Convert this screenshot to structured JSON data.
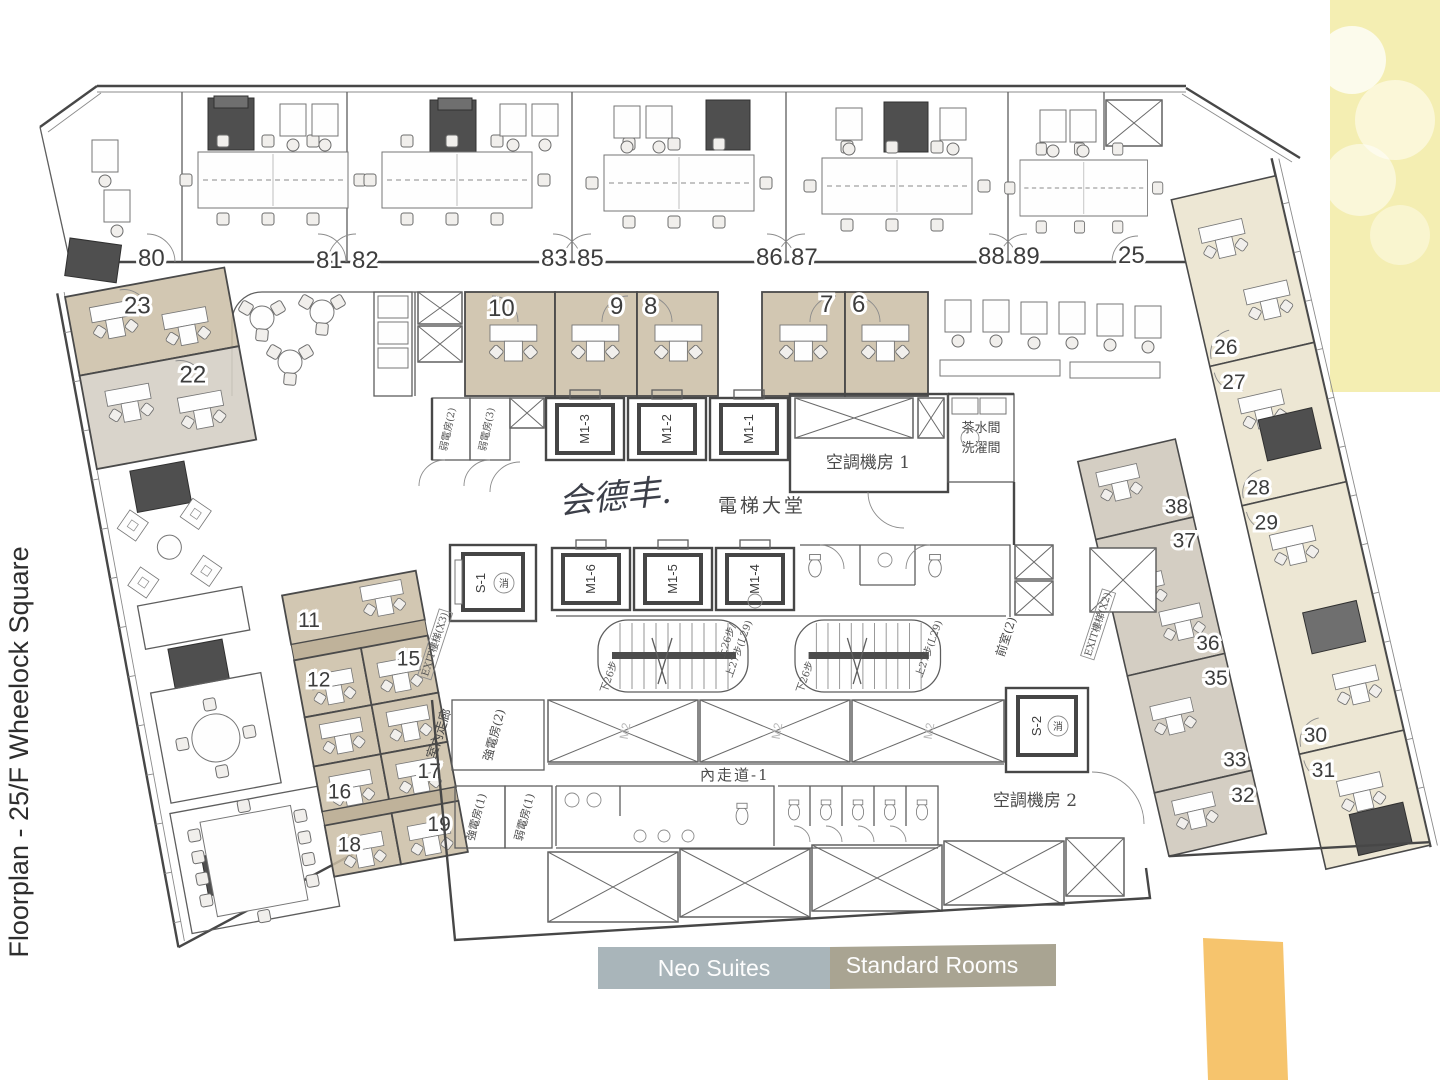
{
  "title": "Floorplan - 25/F Wheelock Square",
  "legend": {
    "neo_suites": "Neo Suites",
    "standard_rooms": "Standard Rooms",
    "neo_color": "#a9b5ba",
    "standard_color": "#a9a492"
  },
  "notes": {
    "yellow_color": "#f4eeb2",
    "orange_color": "#f6c46d"
  },
  "rooms": {
    "top_band": [
      "80",
      "81",
      "82",
      "83",
      "85",
      "86",
      "87",
      "88",
      "89",
      "25"
    ],
    "suite_band": [
      "10",
      "9",
      "8",
      "7",
      "6"
    ],
    "left_upper": [
      "23",
      "22"
    ],
    "left_lower": [
      "11",
      "12",
      "15",
      "16",
      "17",
      "18",
      "19"
    ],
    "right_inner": [
      "38",
      "37",
      "36",
      "35",
      "33",
      "32"
    ],
    "right_outer": [
      "26",
      "27",
      "28",
      "29",
      "30",
      "31"
    ]
  },
  "elevators": {
    "m1_1": "M1-1",
    "m1_2": "M1-2",
    "m1_3": "M1-3",
    "m1_4": "M1-4",
    "m1_5": "M1-5",
    "m1_6": "M1-6",
    "s_1": "S-1",
    "s_2": "S-2",
    "m2": "M2"
  },
  "core": {
    "lift_lobby": "電梯大堂",
    "handwriting": "会德丰.",
    "machine_room_1": "空調機房  1",
    "machine_room_2": "空調機房  2",
    "corridor_1": "內走道-1",
    "pantry": "茶水間",
    "wash_room": "洗濯間",
    "weak_elec_2": "弱電房(2)",
    "weak_elec_3": "弱電房(3)",
    "weak_elec_1": "弱電房(1)",
    "strong_elec_2": "強電房(2)",
    "strong_elec_1": "強電房(1)",
    "indoor_corridor": "室內走廊",
    "anteroom_2": "前室(2)",
    "exit_stair_x3": "EXIT樓梯(X3)",
    "exit_stair_x2": "EXIT樓梯(X2)",
    "stair_up": "上27步(L29)",
    "stair_up2": "上26步/",
    "stair_down": "下26步",
    "fire_lift": "消"
  }
}
